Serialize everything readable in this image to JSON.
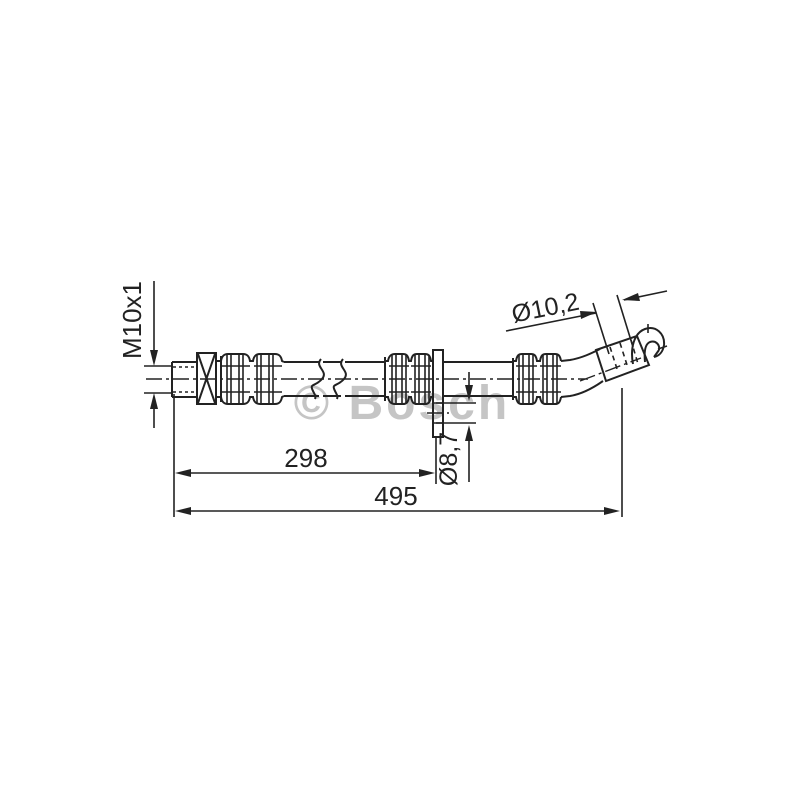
{
  "watermark": "© Bosch",
  "annotations": {
    "thread": "M10x1",
    "hose_od": "Ø10,2",
    "bracket_hole": "Ø8,7",
    "length_to_bracket": "298",
    "overall_length": "495"
  },
  "colors": {
    "line": "#222222",
    "watermark": "#c5c5c5",
    "background": "#ffffff"
  }
}
